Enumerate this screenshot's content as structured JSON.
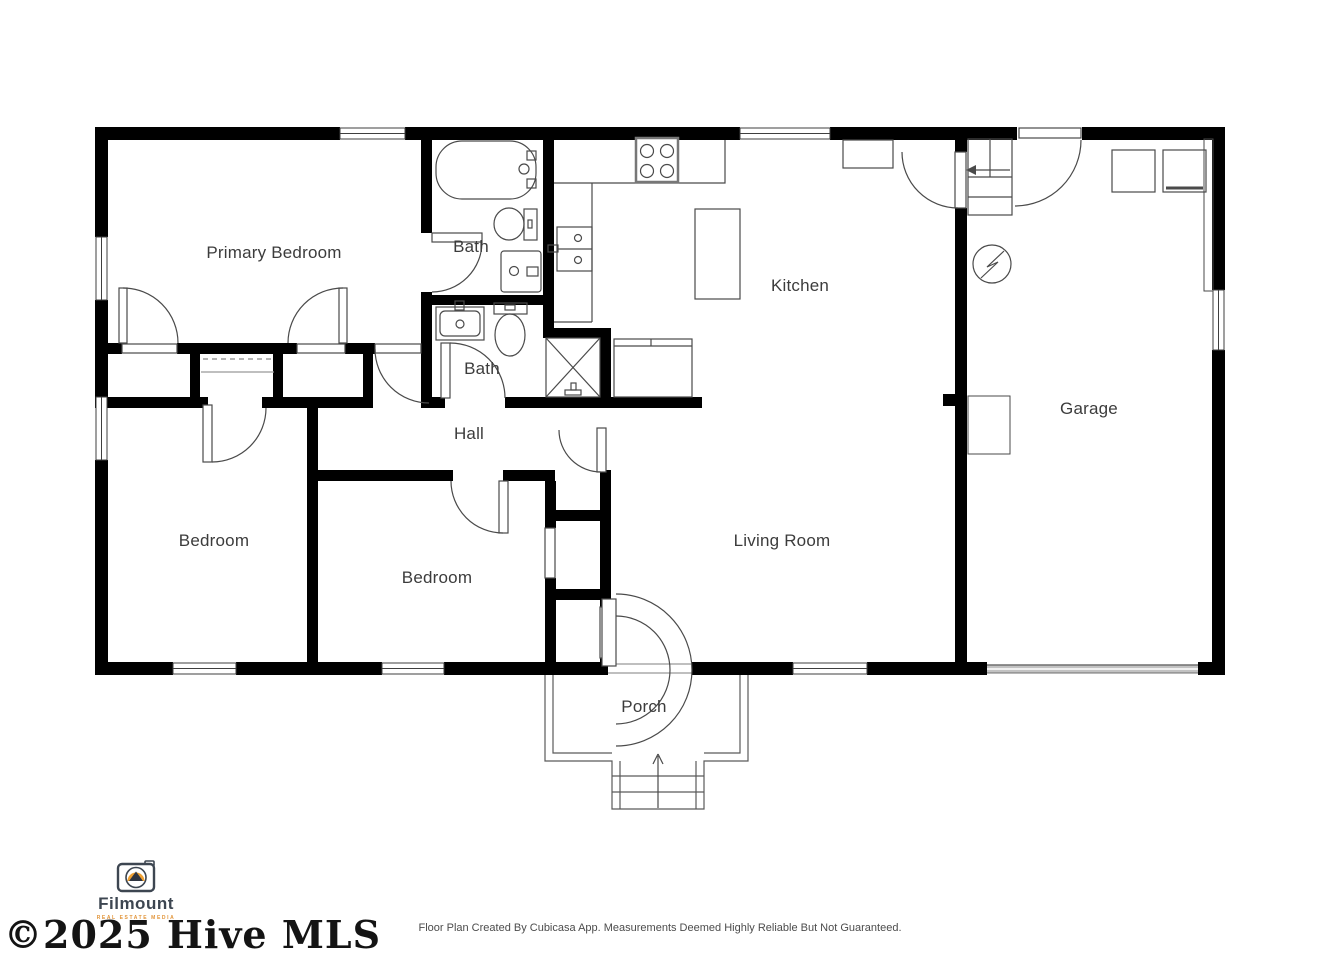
{
  "page": {
    "background": "#ffffff"
  },
  "floor_plan": {
    "wall_color": "#000000",
    "fixture_line_color": "#4a4a4a",
    "rooms": [
      {
        "name": "primary-bedroom",
        "label": "Primary Bedroom"
      },
      {
        "name": "bath-upper",
        "label": "Bath"
      },
      {
        "name": "bath-lower",
        "label": "Bath"
      },
      {
        "name": "kitchen",
        "label": "Kitchen"
      },
      {
        "name": "hall",
        "label": "Hall"
      },
      {
        "name": "bedroom-left",
        "label": "Bedroom"
      },
      {
        "name": "bedroom-middle",
        "label": "Bedroom"
      },
      {
        "name": "living-room",
        "label": "Living Room"
      },
      {
        "name": "garage",
        "label": "Garage"
      },
      {
        "name": "porch",
        "label": "Porch"
      }
    ]
  },
  "branding": {
    "name": "Filmount",
    "tagline": "REAL ESTATE MEDIA",
    "text_color": "#3d4651",
    "accent_color": "#f0a132"
  },
  "watermark": {
    "text": "©2025 Hive MLS",
    "color": "#141414"
  },
  "footer": {
    "disclaimer": "Floor Plan Created By Cubicasa App. Measurements Deemed Highly Reliable But Not Guaranteed."
  }
}
